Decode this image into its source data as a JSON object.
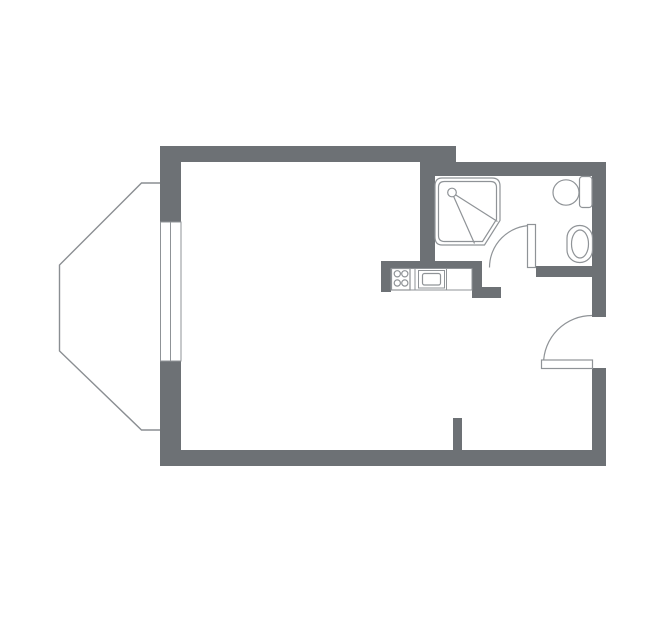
{
  "canvas": {
    "width": 659,
    "height": 630,
    "background": "#ffffff"
  },
  "colors": {
    "wall": "#6d7175",
    "fixture_line": "#8f9397",
    "bay_line": "#8a8e92",
    "white": "#ffffff"
  },
  "floorplan": {
    "walls": [
      {
        "name": "top-main",
        "x": 160,
        "y": 146,
        "w": 296,
        "h": 16
      },
      {
        "name": "top-bathroom",
        "x": 420,
        "y": 162,
        "w": 186,
        "h": 14
      },
      {
        "name": "left-upper",
        "x": 160,
        "y": 146,
        "w": 21,
        "h": 77
      },
      {
        "name": "left-lower",
        "x": 160,
        "y": 361,
        "w": 21,
        "h": 105
      },
      {
        "name": "bottom",
        "x": 160,
        "y": 450,
        "w": 446,
        "h": 16
      },
      {
        "name": "right-upper",
        "x": 592,
        "y": 162,
        "w": 14,
        "h": 155
      },
      {
        "name": "right-lower",
        "x": 592,
        "y": 368,
        "w": 14,
        "h": 98
      },
      {
        "name": "bathroom-divider",
        "x": 420,
        "y": 162,
        "w": 15,
        "h": 107
      },
      {
        "name": "kitchen-back",
        "x": 381,
        "y": 261,
        "w": 101,
        "h": 8
      },
      {
        "name": "kitchen-left-leg",
        "x": 381,
        "y": 261,
        "w": 10,
        "h": 31
      },
      {
        "name": "kitchen-right-leg",
        "x": 472,
        "y": 261,
        "w": 10,
        "h": 37
      },
      {
        "name": "kitchen-foot",
        "x": 482,
        "y": 287,
        "w": 19,
        "h": 11
      },
      {
        "name": "bathroom-bottom",
        "x": 536,
        "y": 266,
        "w": 70,
        "h": 11
      },
      {
        "name": "entry-stub",
        "x": 453,
        "y": 418,
        "w": 9,
        "h": 34
      }
    ],
    "window": {
      "x": 160.5,
      "y": 222,
      "w": 20.5,
      "h": 139,
      "mid_x": 170.5
    },
    "bay_window": {
      "points": "160,183 141.5,183 59.5,265 59.5,351 141.5,430 160,430"
    },
    "shower": {
      "outer_path": "M442,178 L492,178 Q500,178 500,186 L500,220.5 L484.5,245 L442,245 Q435,245 435,237 L435,186 Q435,178 442,178 Z",
      "inner_path": "M444.5,181.5 L490.5,181.5 Q496.5,181.5 496.5,187.5 L496.5,219.3 L482.5,241.5 L444.5,241.5 Q438.5,241.5 438.5,235.5 L438.5,187.5 Q438.5,181.5 444.5,181.5 Z",
      "head": {
        "cx": 452,
        "cy": 192.5,
        "r": 4.3
      },
      "spray": [
        [
          455.6,
          194.9,
          497.5,
          221.5
        ],
        [
          453.7,
          196.6,
          474.5,
          243.5
        ]
      ]
    },
    "kitchen": {
      "counter": {
        "x": 391,
        "y": 268.5,
        "w": 81,
        "h": 21.5
      },
      "stove": {
        "x": 391.5,
        "y": 268.5,
        "w": 18.5,
        "h": 21.5
      },
      "burners": [
        {
          "cx": 397.3,
          "cy": 273.8
        },
        {
          "cx": 404.8,
          "cy": 273.8
        },
        {
          "cx": 397.3,
          "cy": 283.0
        },
        {
          "cx": 404.8,
          "cy": 283.0
        }
      ],
      "burner_r": 3.1,
      "dividers": [
        415,
        446.5
      ],
      "oven_outer": {
        "x": 418.5,
        "y": 270.5,
        "w": 26,
        "h": 17.5
      },
      "oven_inner": {
        "x": 422.5,
        "y": 273.5,
        "w": 18,
        "h": 11.5,
        "r": 2
      }
    },
    "toilet": {
      "bowl": {
        "cx": 566,
        "cy": 192.5,
        "rx": 13,
        "ry": 12.7
      },
      "tank": {
        "x": 579.5,
        "y": 176.5,
        "w": 12.5,
        "h": 31,
        "r": 3
      }
    },
    "sink": {
      "outer": {
        "x": 567,
        "y": 225.5,
        "w": 25.5,
        "h": 37,
        "r": 12.5
      },
      "basin": {
        "cx": 580,
        "cy": 244,
        "rx": 8.5,
        "ry": 14
      }
    },
    "doors": [
      {
        "name": "bathroom-door",
        "leaf": {
          "x": 527.5,
          "y": 224.5,
          "w": 8,
          "h": 43
        },
        "arc": "M489.5,267.5 A42,42 0 0 1 531.5,225.5"
      },
      {
        "name": "entrance-door",
        "leaf": {
          "x": 541.5,
          "y": 360,
          "w": 51,
          "h": 8.5
        },
        "arc": "M543.5,364 A48.5,48.5 0 0 1 592,315.5"
      }
    ]
  }
}
